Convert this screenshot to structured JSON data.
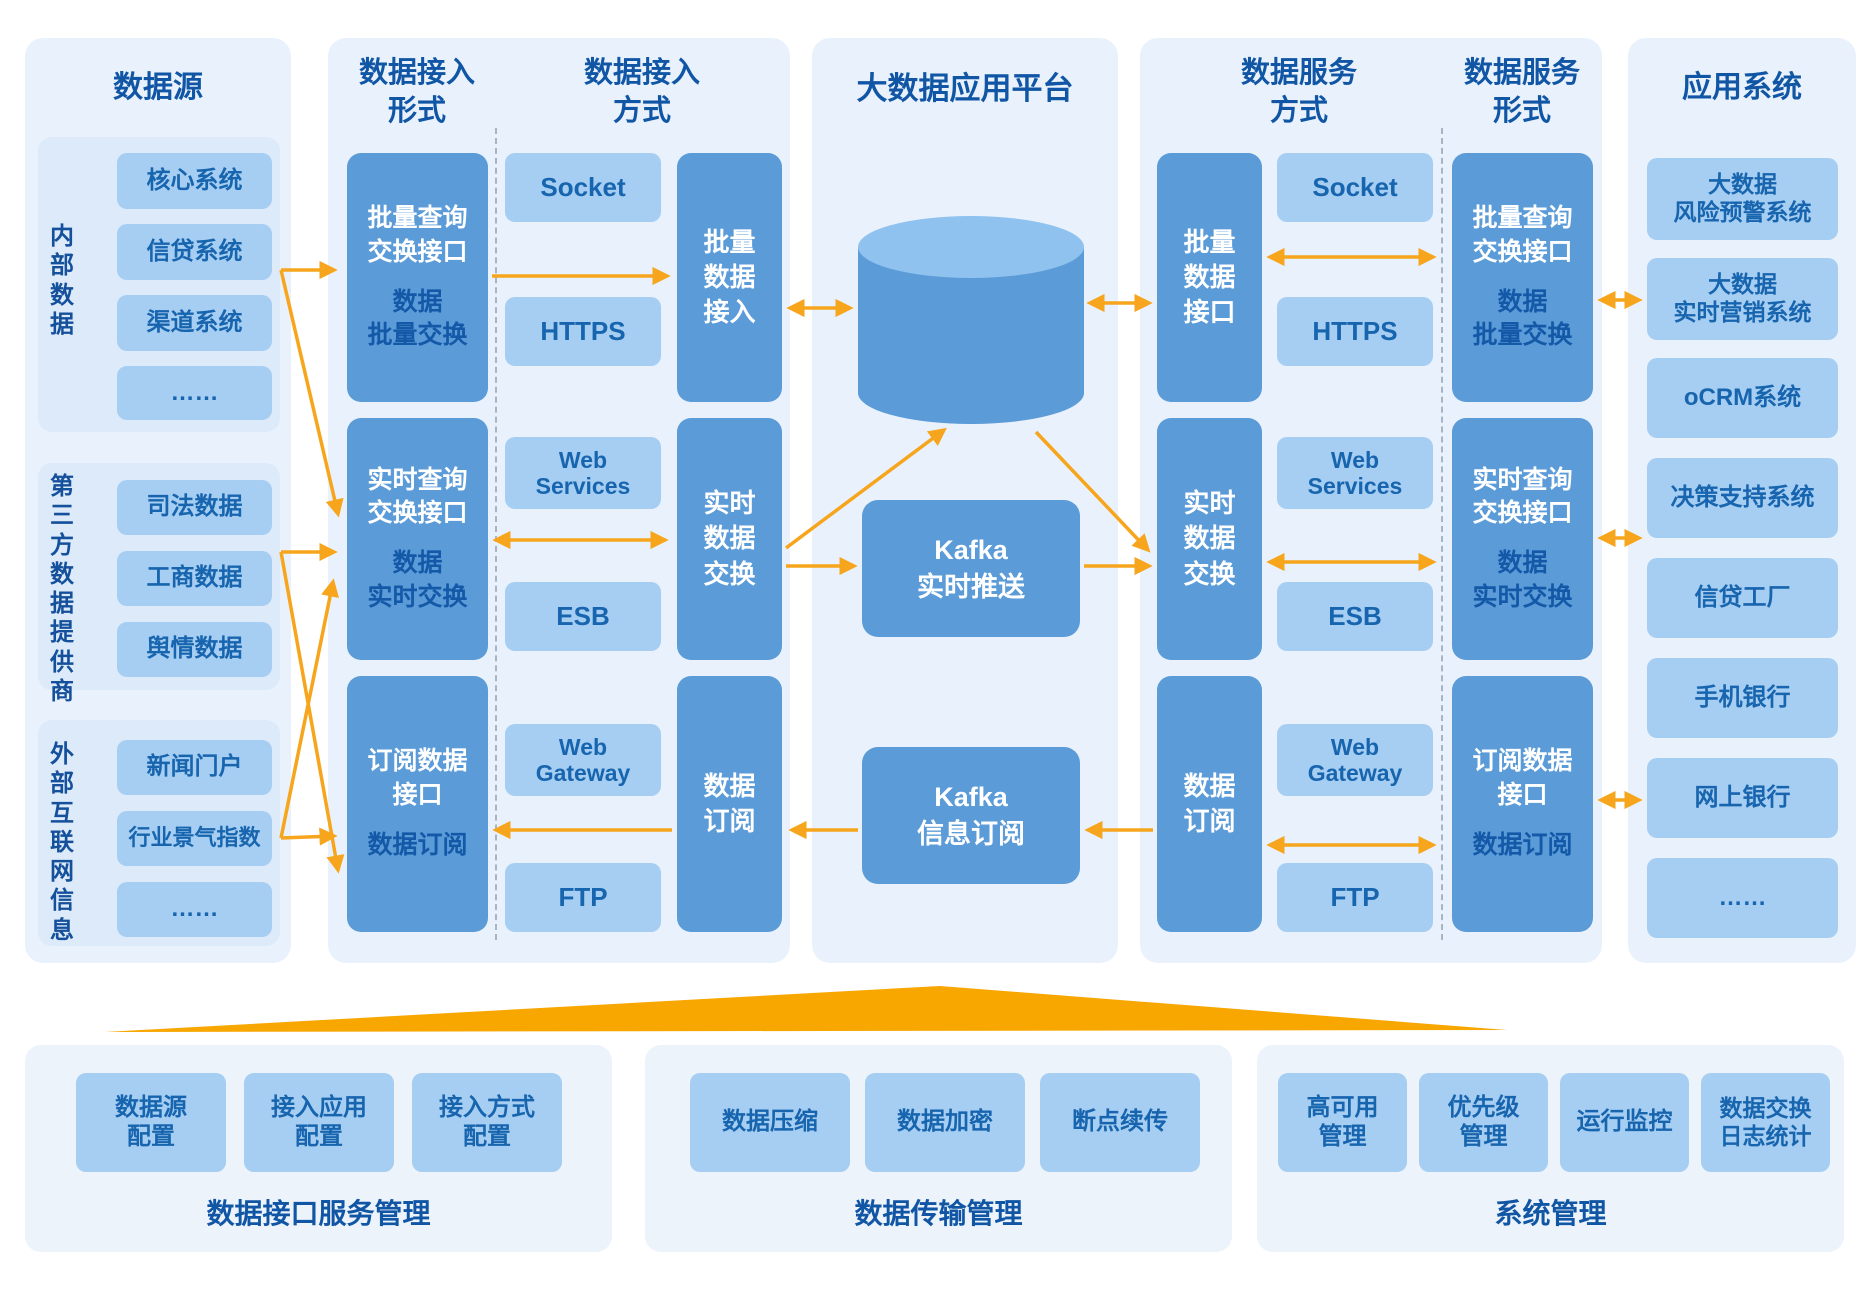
{
  "colors": {
    "accent_orange": "#F8A600",
    "arrow_orange": "#F6A51C",
    "panel_bg": "#E9F2FC",
    "dark_box_blue": "#5B9BD8",
    "light_box_blue": "#A6CDF2",
    "title_blue": "#1156A5",
    "navy_text": "#1459A8"
  },
  "sources": {
    "title": "数据源",
    "groups": [
      {
        "label": "内部数据",
        "items": [
          "核心系统",
          "信贷系统",
          "渠道系统",
          "……"
        ]
      },
      {
        "label": "第三方数据提供商",
        "items": [
          "司法数据",
          "工商数据",
          "舆情数据"
        ]
      },
      {
        "label": "外部互联网信息",
        "items": [
          "新闻门户",
          "行业景气指数",
          "……"
        ]
      }
    ]
  },
  "ingest": {
    "form_title": "数据接入\n形式",
    "mode_title": "数据接入\n方式",
    "form_boxes": [
      {
        "white": "批量查询\n交换接口",
        "navy": "数据\n批量交换"
      },
      {
        "white": "实时查询\n交换接口",
        "navy": "数据\n实时交换"
      },
      {
        "white": "订阅数据\n接口",
        "navy": "数据订阅"
      }
    ],
    "protocols": [
      "Socket",
      "HTTPS",
      "Web\nServices",
      "ESB",
      "Web\nGateway",
      "FTP"
    ],
    "mode_boxes": [
      "批量\n数据\n接入",
      "实时\n数据\n交换",
      "数据\n订阅"
    ]
  },
  "platform": {
    "title": "大数据应用平台",
    "hadoop": "Hadoop\n大数据平台",
    "kafka_push": "Kafka\n实时推送",
    "kafka_sub": "Kafka\n信息订阅"
  },
  "service": {
    "mode_title": "数据服务\n方式",
    "form_title": "数据服务\n形式",
    "mode_boxes": [
      "批量\n数据\n接口",
      "实时\n数据\n交换",
      "数据\n订阅"
    ],
    "protocols": [
      "Socket",
      "HTTPS",
      "Web\nServices",
      "ESB",
      "Web\nGateway",
      "FTP"
    ],
    "form_boxes": [
      {
        "white": "批量查询\n交换接口",
        "navy": "数据\n批量交换"
      },
      {
        "white": "实时查询\n交换接口",
        "navy": "数据\n实时交换"
      },
      {
        "white": "订阅数据\n接口",
        "navy": "数据订阅"
      }
    ]
  },
  "apps": {
    "title": "应用系统",
    "items": [
      "大数据\n风险预警系统",
      "大数据\n实时营销系统",
      "oCRM系统",
      "决策支持系统",
      "信贷工厂",
      "手机银行",
      "网上银行",
      "……"
    ]
  },
  "management": {
    "panels": [
      {
        "caption": "数据接口服务管理",
        "items": [
          "数据源\n配置",
          "接入应用\n配置",
          "接入方式\n配置"
        ]
      },
      {
        "caption": "数据传输管理",
        "items": [
          "数据压缩",
          "数据加密",
          "断点续传"
        ]
      },
      {
        "caption": "系统管理",
        "items": [
          "高可用\n管理",
          "优先级\n管理",
          "运行监控",
          "数据交换\n日志统计"
        ]
      }
    ]
  }
}
